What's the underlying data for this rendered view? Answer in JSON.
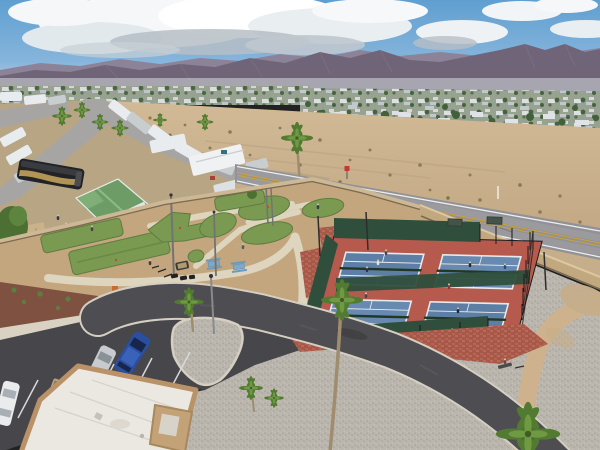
{
  "meta": {
    "type": "aerial-photograph",
    "description": "Drone aerial view of a desert RV resort with four pickleball courts, a miniature golf course, entrance drive, parking lot, palm trees, a two-lane highway, a mobile-home town and mountains on the horizon"
  },
  "colors": {
    "sky_top": "#5f9fd0",
    "sky_mid": "#86b5dc",
    "sky_horizon": "#c9dbe7",
    "cloud_white": "#f5f7f8",
    "cloud_bright": "#ffffff",
    "cloud_shadow": "#b6bec6",
    "mountain_back": "#8d8398",
    "mountain_front": "#6f6478",
    "mountain_detail": "#7d7286",
    "haze": "#d3dade",
    "town_base": "#97a291",
    "town_tree": "#42603b",
    "town_house": "#e0e3e5",
    "town_house2": "#c3c9cd",
    "desert_sand": "#d2ba97",
    "desert_sand2": "#c2a883",
    "desert_shrub": "#8a7a58",
    "desert_shrub_green": "#6d7a4a",
    "highway_asphalt": "#919196",
    "highway_wear": "#9d9da1",
    "line_white": "#ebedee",
    "line_yellow": "#c9a23c",
    "retaining_wall": "#c2a87f",
    "wall_top": "#dcc8a2",
    "wall_shadow": "#7a6a50",
    "perimeter_wall": "#cdb896",
    "rv_ground": "#b7a584",
    "rv_street": "#a7a5a4",
    "trailer_white": "#e9ecee",
    "trailer_gray": "#c8cdd0",
    "coach_black": "#222326",
    "coach_accent": "#b29455",
    "house_green": "#6d9c66",
    "house_green_light": "#8fba88",
    "shed_tan": "#cbb28b",
    "minigolf_dirt": "#c3a67e",
    "path_cream": "#ded5bf",
    "green_turf": "#7a9a52",
    "green_turf_dark": "#5e7c40",
    "court_red": "#b65a4e",
    "brick_red": "#a85848",
    "brick_dot": "#c57a66",
    "court_blue": "#5d7fa6",
    "court_blue_light": "#6889b0",
    "court_line": "#e8ebed",
    "net_dark": "#223826",
    "windscreen": "#2f4f3c",
    "fence_dark": "#1a1a1a",
    "internal_road": "#4e4e52",
    "curb": "#d5cfc2",
    "gravel": "#bab6ae",
    "gravel_dot": "#a19d94",
    "dirt_path": "#cdb28d",
    "mulch": "#7e5140",
    "plant_green": "#5f7d3f",
    "sidewalk": "#d9d2c2",
    "parking_asphalt": "#47474b",
    "stripe_white": "#d9d9d9",
    "roof_white": "#ebe8e1",
    "roof_seam": "#d5d2cb",
    "parapet_tan": "#ba9268",
    "wing_tan": "#c2a276",
    "palm_frond": "#527a31",
    "palm_frond_light": "#6f9a42",
    "palm_trunk": "#a08c6e",
    "car_blue": "#2b4fa0",
    "car_silver": "#c7cbd0",
    "car_white": "#e9ebed",
    "cart_tan": "#b9a383",
    "table_blue": "#7fa9c9",
    "person_dark": "#2c3248",
    "person_light": "#e6e6e6",
    "sign_red": "#c03a2e",
    "tree_green": "#4c7033",
    "canopy_green": "#44544a"
  },
  "scene": {
    "setting": "desert RV resort, daytime, partly cloudy",
    "background": [
      "mountain range",
      "mobile home community with trees",
      "vacant desert lot"
    ],
    "highway": {
      "lanes": 2,
      "markings": [
        "double yellow center line",
        "white edge lines"
      ],
      "signs": [
        "red marker sign",
        "white post"
      ]
    },
    "resort": {
      "pickleball_courts": {
        "count": 4,
        "surface": "blue courts on red base",
        "players": 10,
        "fence": "black chain-link with dark green windscreens",
        "shade_canopies": 2
      },
      "mini_golf": {
        "putting_greens": 9,
        "ground": "tan decomposed granite with cream concrete paths",
        "light_poles": 4
      },
      "picnic_tables": {
        "count": 2,
        "color": "blue"
      },
      "entrance_drive": {
        "surface": "dark asphalt",
        "median_island": "gravel teardrop with palm and lamp post"
      },
      "parking": {
        "cars": [
          "blue SUV",
          "silver sedan",
          "white car"
        ],
        "golf_cart": 1,
        "striped_stalls": true
      },
      "clubhouse": {
        "roof": "white flat roof with tan parapet"
      },
      "rv_park": {
        "rvs_and_trailers": "white motorhomes and park models",
        "luxury_coach": "black with gold swoosh",
        "house_roof": "green gabled"
      },
      "perimeter": "tan block wall",
      "people_on_grounds": 5,
      "bicycles": 3,
      "bench_sitter": 1
    },
    "vegetation": {
      "tall_palms": 4,
      "small_palms": 9,
      "shrubs": "desert scrub",
      "bougainvillea": "red-orange"
    }
  }
}
